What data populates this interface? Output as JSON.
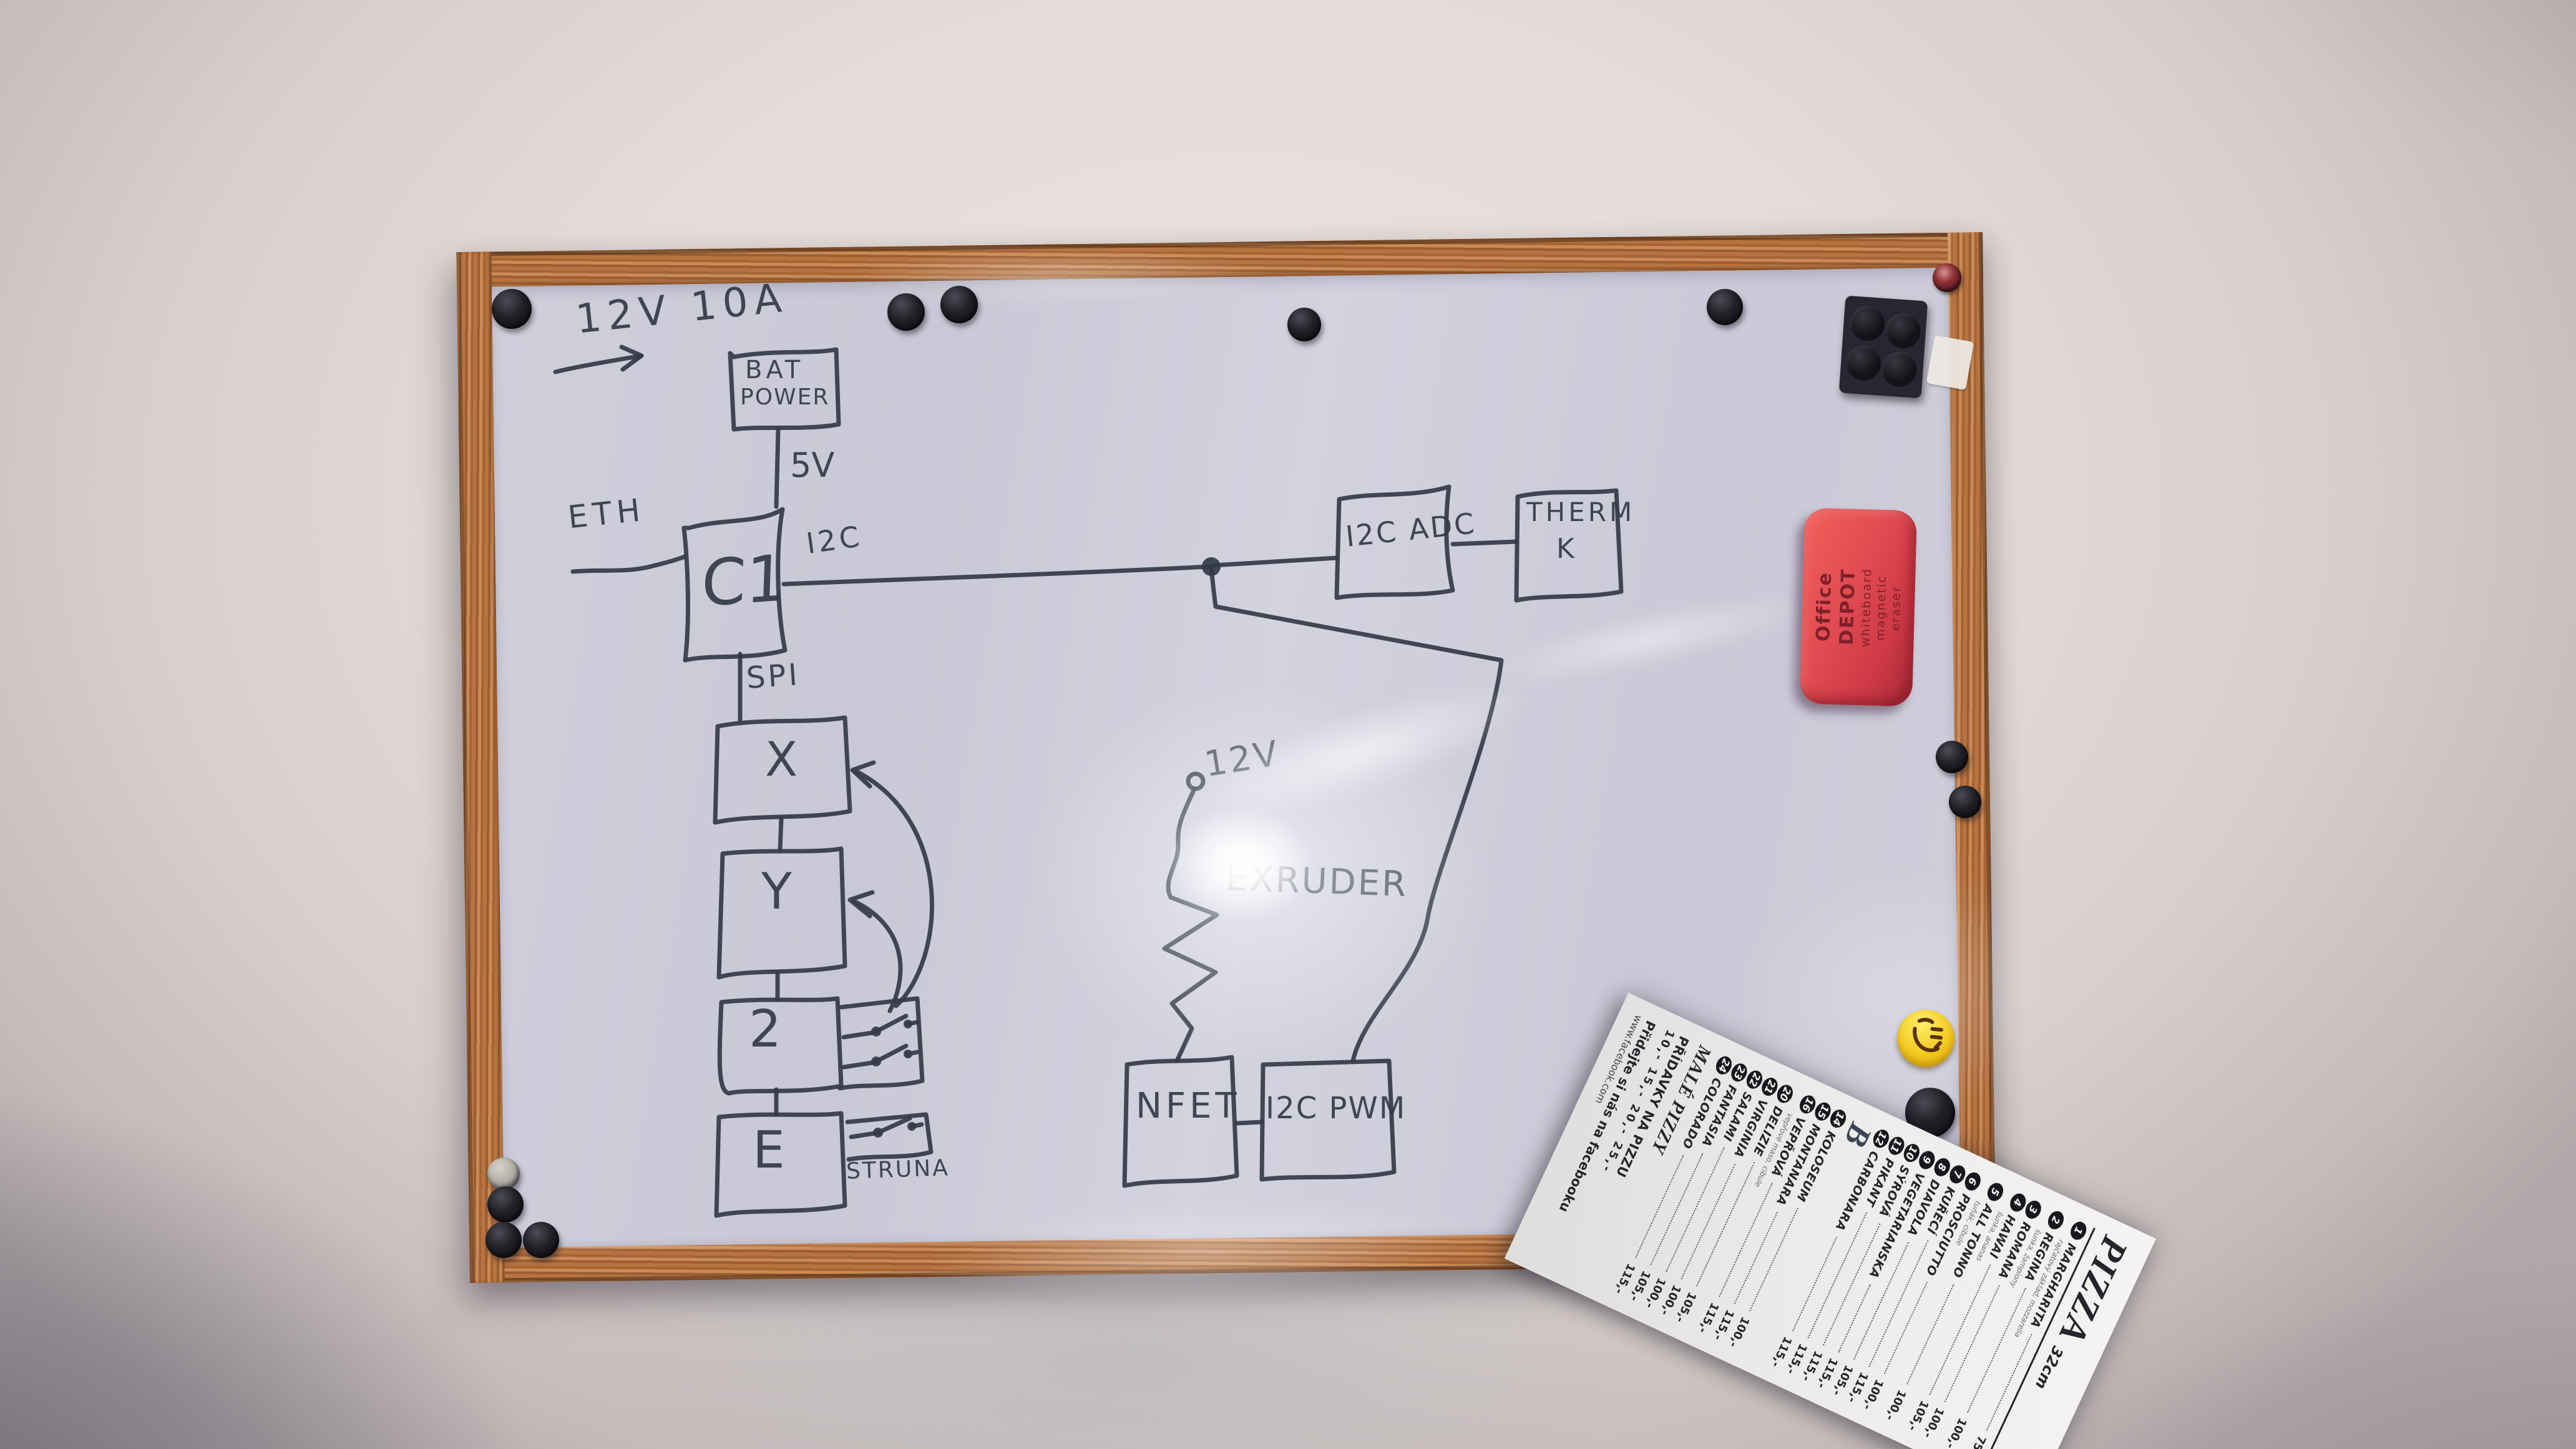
{
  "photo": {
    "description": "Whiteboard photo with hand-drawn electronics block diagram, magnets, eraser and pizza menu leaflet"
  },
  "diagram": {
    "power_note": "12V 10A",
    "labels": {
      "bat_line1": "BAT",
      "bat_line2": "POWER",
      "c1": "C1",
      "x": "X",
      "y": "Y",
      "z": "2",
      "e": "E",
      "nfet": "NFET",
      "i2c_pwm": "I2C PWM",
      "i2c_adc": "I2C ADC",
      "therm_line1": "THERM",
      "therm_line2": "K"
    },
    "edge_labels": {
      "eth": "ETH",
      "v5": "5V",
      "i2c": "I2C",
      "spi": "SPI",
      "v12": "12V",
      "extruder": "EXRUDER",
      "struna": "STRUNA"
    }
  },
  "eraser": {
    "brand": "Office DEPOT",
    "product": "whiteboard magnetic eraser"
  },
  "menu": {
    "title": "PIZZA",
    "size_note": "32cm",
    "items": [
      {
        "num": "1",
        "name": "MARGHARITA",
        "sub": "rajčatový základ, mozzarella",
        "price": "75,-"
      },
      {
        "num": "2",
        "name": "REGINA",
        "sub": "šunka, žampiony",
        "price": "100,-"
      },
      {
        "num": "3",
        "name": "ROMANA",
        "sub": "",
        "price": "100,-"
      },
      {
        "num": "4",
        "name": "HAWAI",
        "sub": "šunka, ananas",
        "price": "105,-"
      },
      {
        "num": "5",
        "name": "ALL TONNO",
        "sub": "tuňák, cibule",
        "price": "100,-"
      },
      {
        "num": "6",
        "name": "PROSCIUTTO",
        "sub": "",
        "price": "100,-"
      },
      {
        "num": "7",
        "name": "KUŘECÍ",
        "sub": "",
        "price": "115,-"
      },
      {
        "num": "8",
        "name": "DIAVOLA",
        "sub": "",
        "price": "105,-"
      },
      {
        "num": "9",
        "name": "VEGETARIANSKA",
        "sub": "",
        "price": "115,-"
      },
      {
        "num": "10",
        "name": "SÝROVÁ",
        "sub": "",
        "price": "115,-"
      },
      {
        "num": "11",
        "name": "PIKANT",
        "sub": "",
        "price": "115,-"
      },
      {
        "num": "12",
        "name": "CARBONARA",
        "sub": "",
        "price": "115,-"
      }
    ],
    "logo_fragment": "B",
    "items2": [
      {
        "num": "14",
        "name": "KOLOSEUM",
        "sub": "",
        "price": "100,-"
      },
      {
        "num": "15",
        "name": "MONTANARA",
        "sub": "",
        "price": "115,-"
      },
      {
        "num": "16",
        "name": "VEPŘOVÁ",
        "sub": "vepřové maso, cibule",
        "price": "115,-"
      },
      {
        "num": "20",
        "name": "DELIZIE",
        "sub": "",
        "price": "105,-"
      },
      {
        "num": "21",
        "name": "VIRGINIA",
        "sub": "",
        "price": "100,-"
      },
      {
        "num": "22",
        "name": "SALAMI",
        "sub": "",
        "price": "100,-"
      },
      {
        "num": "23",
        "name": "FANTASIA",
        "sub": "",
        "price": "105,-"
      },
      {
        "num": "24",
        "name": "COLORADO",
        "sub": "",
        "price": "115,-"
      }
    ],
    "small_heading": "MALÉ PIZZY",
    "extras_heading": "PŘÍDAVKY NA PIZZU",
    "extras_prices": "10,-  15,-  20,-  25,-",
    "footer": "Přidejte si nás na facebooku",
    "url": "www.facebook.com"
  }
}
